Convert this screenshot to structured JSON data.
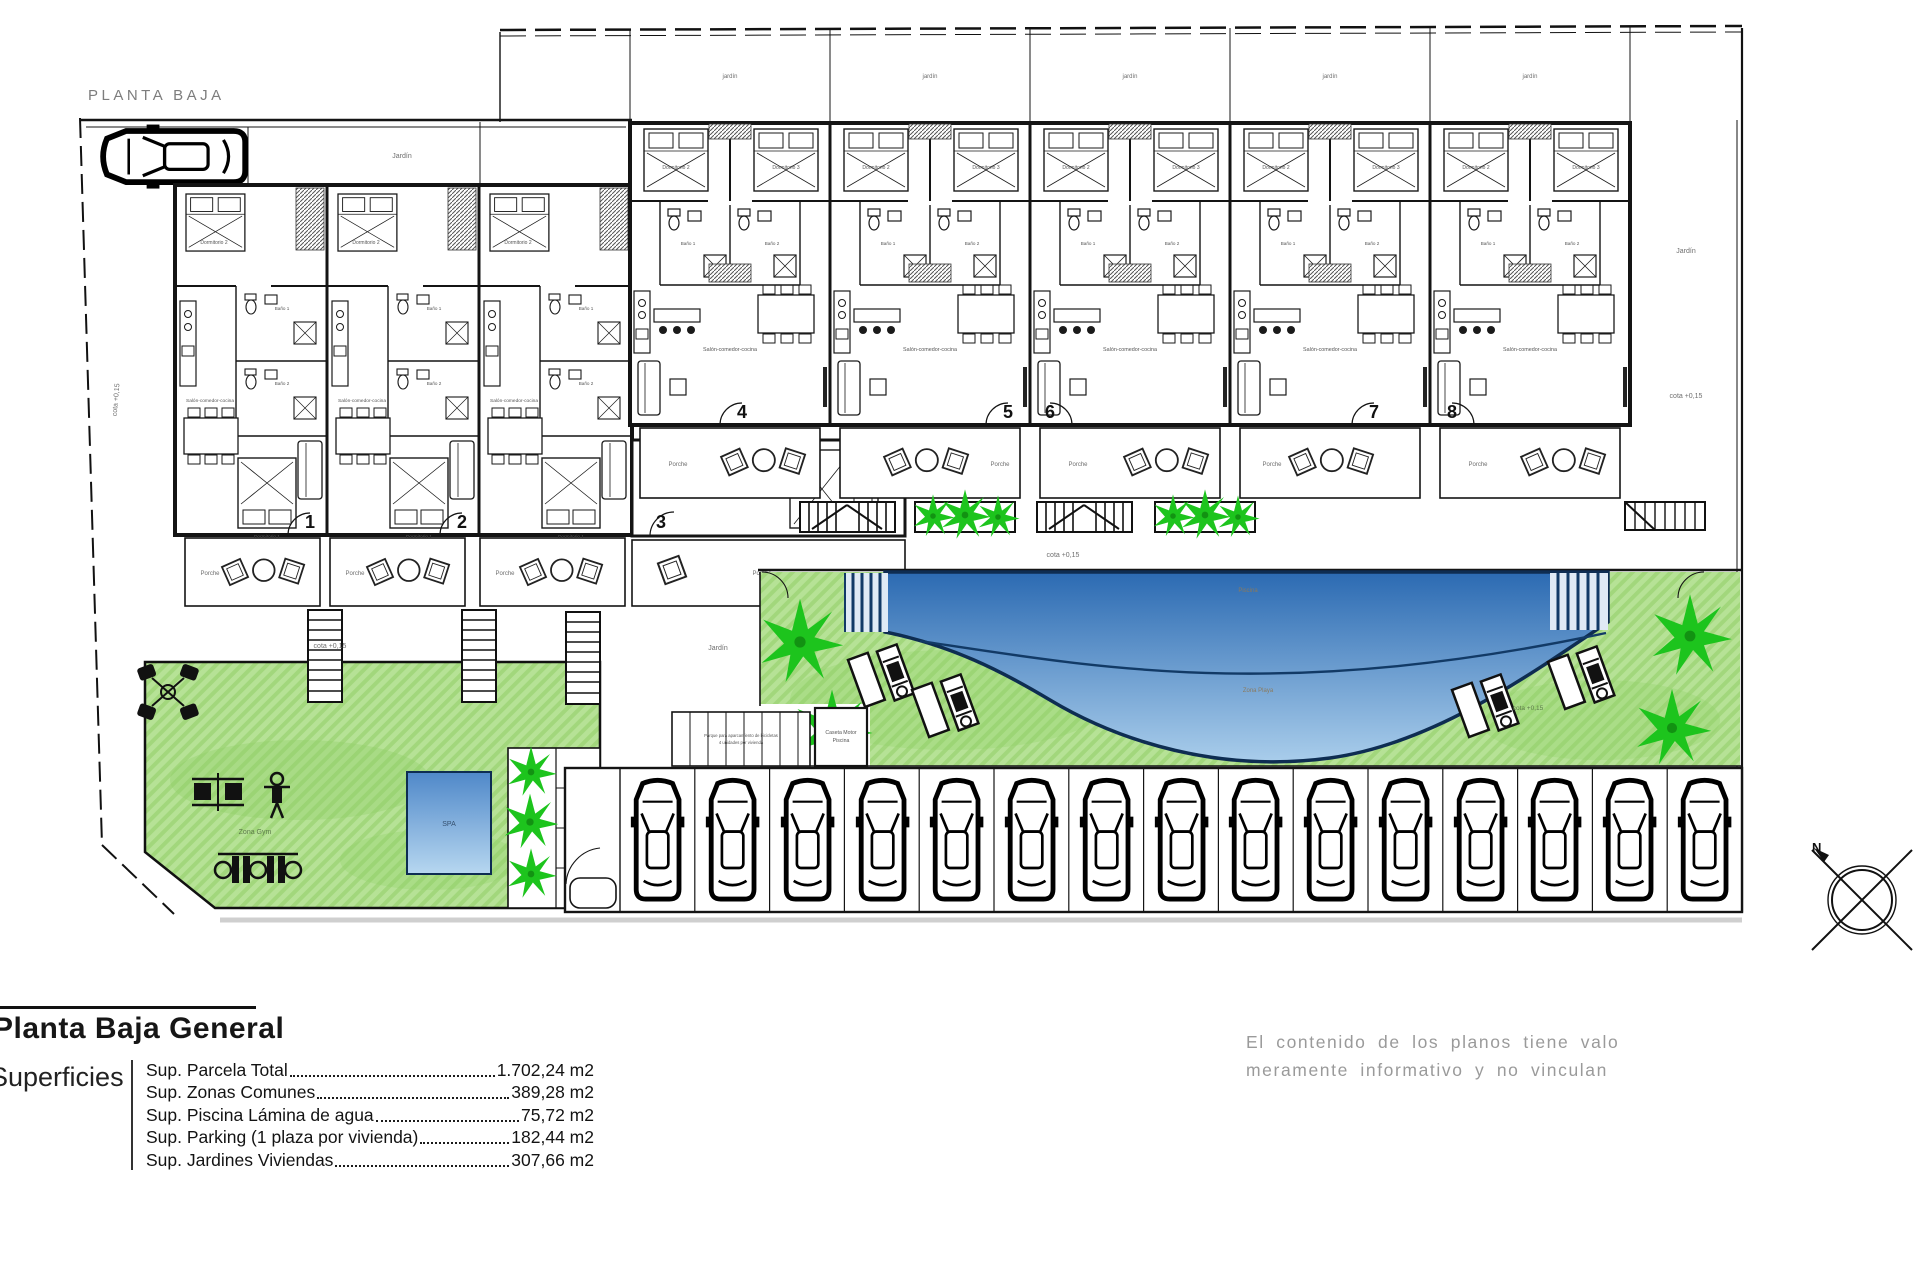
{
  "plan": {
    "title": "PLANTA BAJA",
    "unit_numbers": [
      "1",
      "2",
      "3",
      "4",
      "5",
      "6",
      "7",
      "8"
    ],
    "labels": {
      "jardin": "Jardín",
      "jardin_small": "jardín",
      "porche": "Porche",
      "cota": "cota +0,15",
      "spa": "SPA",
      "zona_gym": "Zona Gym",
      "piscina": "Piscina",
      "zona_playa": "Zona Playa",
      "caseta_1": "Caseta Motor",
      "caseta_2": "Piscina",
      "bike_note_1": "Parque para aparcamiento de bicicletas",
      "bike_note_2": "4 unidades por vivienda"
    },
    "rooms": {
      "dorm1": "Dormitorio 1",
      "dorm2": "Dormitorio 2",
      "dorm3": "Dormitorio 3",
      "bano1": "Baño 1",
      "bano2": "Baño 2",
      "salon": "Salón-comedor-cocina"
    },
    "compass_n": "N"
  },
  "legend": {
    "title": "Planta Baja General",
    "section": "Superficies",
    "rows": [
      {
        "label": "Sup. Parcela Total ",
        "value": "1.702,24 m2"
      },
      {
        "label": "Sup. Zonas Comunes ",
        "value": "389,28 m2"
      },
      {
        "label": "Sup. Piscina Lámina de agua",
        "value": "75,72 m2"
      },
      {
        "label": "Sup. Parking (1 plaza por vivienda)",
        "value": "182,44 m2"
      },
      {
        "label": "Sup. Jardines Viviendas",
        "value": "307,66 m2"
      }
    ],
    "disclaimer": [
      "El contenido de los planos tiene valo",
      "meramente informativo y no vinculan"
    ]
  }
}
